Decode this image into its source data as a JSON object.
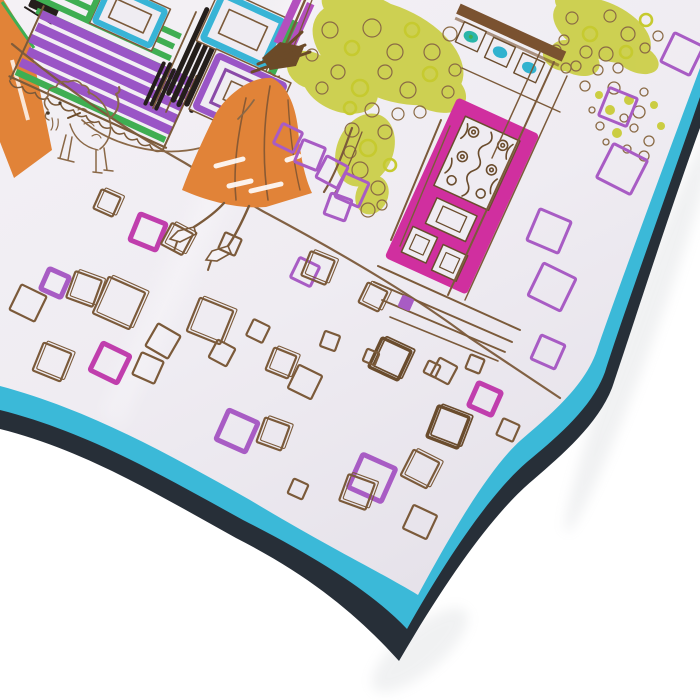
{
  "meta": {
    "description": "Product photo of a square silk scarf laid diagonally on a white background, corner pointing down. The scarf print is a hand-sketched Paris street scene: a woman in an orange coat and brown hat walking a small fluffy dog on a leash, storefronts with a purple striped awning, teal and purple windows, black hatched columns, chartreuse scribbled trees, a pink door with iron scrollwork, and scattered hand-drawn cobblestone squares in brown, purple and magenta. The scarf has a bright turquoise border with a dark navy edge."
  },
  "palette": {
    "background": "#ffffff",
    "fabric": "#efecf2",
    "fabric_dark": "#e6e2ea",
    "turquoise": "#3bb9d8",
    "navy": "#272f38",
    "orange": "#e18338",
    "green": "#3fae52",
    "teal": "#38b4d6",
    "purple": "#9a55c6",
    "purple_square": "#a85cc4",
    "magenta": "#d02f9f",
    "magenta_square": "#c03ead",
    "chartreuse": "#c6ca2f",
    "brown": "#7b5a3a",
    "brown_dark": "#6a4c2d",
    "black_ink": "#241e1b",
    "shadow": "#9aa0a8"
  },
  "scene": {
    "tilt_deg": 24.5,
    "cobblestones": [
      {
        "x": 107,
        "y": 203,
        "s": 21,
        "c": "b",
        "r": 24,
        "d": 1
      },
      {
        "x": 148,
        "y": 232,
        "s": 28,
        "c": "m",
        "r": 22,
        "d": 0
      },
      {
        "x": 177,
        "y": 239,
        "s": 24,
        "c": "b",
        "r": 28,
        "d": 1
      },
      {
        "x": 55,
        "y": 283,
        "s": 22,
        "c": "pt",
        "r": 24,
        "d": 0
      },
      {
        "x": 84,
        "y": 289,
        "s": 28,
        "c": "b",
        "r": 20,
        "d": 1
      },
      {
        "x": 28,
        "y": 303,
        "s": 28,
        "c": "b",
        "r": 26,
        "d": 0
      },
      {
        "x": 119,
        "y": 303,
        "s": 40,
        "c": "b",
        "r": 24,
        "d": 1
      },
      {
        "x": 163,
        "y": 341,
        "s": 26,
        "c": "b",
        "r": 30,
        "d": 0
      },
      {
        "x": 210,
        "y": 321,
        "s": 36,
        "c": "b",
        "r": 22,
        "d": 1
      },
      {
        "x": 258,
        "y": 331,
        "s": 18,
        "c": "b",
        "r": 26,
        "d": 0
      },
      {
        "x": 230,
        "y": 244,
        "s": 18,
        "c": "b",
        "r": 24,
        "d": 0
      },
      {
        "x": 288,
        "y": 138,
        "s": 22,
        "c": "p",
        "r": 26,
        "d": 0
      },
      {
        "x": 310,
        "y": 155,
        "s": 24,
        "c": "p",
        "r": 22,
        "d": 0
      },
      {
        "x": 332,
        "y": 172,
        "s": 24,
        "c": "p",
        "r": 28,
        "d": 0
      },
      {
        "x": 352,
        "y": 190,
        "s": 26,
        "c": "p",
        "r": 24,
        "d": 0
      },
      {
        "x": 338,
        "y": 207,
        "s": 22,
        "c": "p",
        "r": 20,
        "d": 0
      },
      {
        "x": 305,
        "y": 272,
        "s": 22,
        "c": "p",
        "r": 26,
        "d": 0
      },
      {
        "x": 318,
        "y": 268,
        "s": 26,
        "c": "b",
        "r": 22,
        "d": 1
      },
      {
        "x": 373,
        "y": 297,
        "s": 22,
        "c": "b",
        "r": 26,
        "d": 1
      },
      {
        "x": 406,
        "y": 303,
        "s": 13,
        "c": "pf",
        "r": 24,
        "d": 0
      },
      {
        "x": 330,
        "y": 341,
        "s": 16,
        "c": "b",
        "r": 20,
        "d": 0
      },
      {
        "x": 390,
        "y": 359,
        "s": 32,
        "c": "bt",
        "r": 25,
        "d": 1
      },
      {
        "x": 444,
        "y": 371,
        "s": 20,
        "c": "b",
        "r": 28,
        "d": 0
      },
      {
        "x": 475,
        "y": 364,
        "s": 15,
        "c": "b",
        "r": 22,
        "d": 0
      },
      {
        "x": 485,
        "y": 399,
        "s": 25,
        "c": "m",
        "r": 24,
        "d": 0
      },
      {
        "x": 448,
        "y": 427,
        "s": 33,
        "c": "bt",
        "r": 21,
        "d": 1
      },
      {
        "x": 420,
        "y": 469,
        "s": 29,
        "c": "b",
        "r": 27,
        "d": 1
      },
      {
        "x": 372,
        "y": 478,
        "s": 36,
        "c": "pt",
        "r": 24,
        "d": 0
      },
      {
        "x": 357,
        "y": 492,
        "s": 28,
        "c": "b",
        "r": 20,
        "d": 1
      },
      {
        "x": 420,
        "y": 522,
        "s": 26,
        "c": "b",
        "r": 25,
        "d": 0
      },
      {
        "x": 508,
        "y": 430,
        "s": 18,
        "c": "b",
        "r": 24,
        "d": 0
      },
      {
        "x": 682,
        "y": 54,
        "s": 32,
        "c": "p",
        "r": 26,
        "d": 0
      },
      {
        "x": 618,
        "y": 107,
        "s": 30,
        "c": "p",
        "r": 22,
        "d": 0
      },
      {
        "x": 622,
        "y": 169,
        "s": 38,
        "c": "p",
        "r": 27,
        "d": 0
      },
      {
        "x": 549,
        "y": 231,
        "s": 34,
        "c": "p",
        "r": 23,
        "d": 0
      },
      {
        "x": 552,
        "y": 287,
        "s": 36,
        "c": "p",
        "r": 26,
        "d": 0
      },
      {
        "x": 548,
        "y": 352,
        "s": 26,
        "c": "p",
        "r": 24,
        "d": 0
      },
      {
        "x": 52,
        "y": 362,
        "s": 30,
        "c": "b",
        "r": 22,
        "d": 1
      },
      {
        "x": 110,
        "y": 363,
        "s": 30,
        "c": "m",
        "r": 26,
        "d": 0
      },
      {
        "x": 148,
        "y": 368,
        "s": 24,
        "c": "b",
        "r": 24,
        "d": 0
      },
      {
        "x": 222,
        "y": 353,
        "s": 20,
        "c": "b",
        "r": 28,
        "d": 0
      },
      {
        "x": 281,
        "y": 363,
        "s": 24,
        "c": "b",
        "r": 22,
        "d": 1
      },
      {
        "x": 305,
        "y": 382,
        "s": 26,
        "c": "b",
        "r": 26,
        "d": 0
      },
      {
        "x": 237,
        "y": 431,
        "s": 32,
        "c": "pt",
        "r": 24,
        "d": 0
      },
      {
        "x": 273,
        "y": 434,
        "s": 26,
        "c": "b",
        "r": 20,
        "d": 1
      },
      {
        "x": 298,
        "y": 489,
        "s": 16,
        "c": "b",
        "r": 24,
        "d": 0
      },
      {
        "x": 371,
        "y": 357,
        "s": 13,
        "c": "b",
        "r": 22,
        "d": 0
      },
      {
        "x": 432,
        "y": 369,
        "s": 13,
        "c": "b",
        "r": 26,
        "d": 0
      }
    ],
    "bubbles": [
      {
        "x": 585,
        "y": 86,
        "r": 5,
        "f": 0
      },
      {
        "x": 599,
        "y": 95,
        "r": 4,
        "f": 1
      },
      {
        "x": 614,
        "y": 88,
        "r": 6,
        "f": 0
      },
      {
        "x": 629,
        "y": 100,
        "r": 5,
        "f": 1
      },
      {
        "x": 644,
        "y": 92,
        "r": 4,
        "f": 0
      },
      {
        "x": 610,
        "y": 110,
        "r": 5,
        "f": 1
      },
      {
        "x": 624,
        "y": 118,
        "r": 4,
        "f": 0
      },
      {
        "x": 639,
        "y": 112,
        "r": 6,
        "f": 0
      },
      {
        "x": 654,
        "y": 105,
        "r": 4,
        "f": 1
      },
      {
        "x": 600,
        "y": 126,
        "r": 4,
        "f": 0
      },
      {
        "x": 617,
        "y": 133,
        "r": 5,
        "f": 1
      },
      {
        "x": 634,
        "y": 128,
        "r": 4,
        "f": 0
      },
      {
        "x": 649,
        "y": 141,
        "r": 5,
        "f": 0
      },
      {
        "x": 661,
        "y": 126,
        "r": 4,
        "f": 1
      },
      {
        "x": 644,
        "y": 156,
        "r": 5,
        "f": 0
      },
      {
        "x": 627,
        "y": 149,
        "r": 4,
        "f": 0
      },
      {
        "x": 592,
        "y": 110,
        "r": 3,
        "f": 0
      },
      {
        "x": 606,
        "y": 142,
        "r": 3,
        "f": 0
      }
    ],
    "tree_main_loops": [
      {
        "x": 330,
        "y": 30,
        "r": 8,
        "g": 0
      },
      {
        "x": 352,
        "y": 48,
        "r": 7,
        "g": 1
      },
      {
        "x": 372,
        "y": 28,
        "r": 9,
        "g": 0
      },
      {
        "x": 395,
        "y": 52,
        "r": 8,
        "g": 0
      },
      {
        "x": 412,
        "y": 30,
        "r": 7,
        "g": 1
      },
      {
        "x": 432,
        "y": 52,
        "r": 8,
        "g": 0
      },
      {
        "x": 450,
        "y": 34,
        "r": 7,
        "g": 0
      },
      {
        "x": 338,
        "y": 72,
        "r": 7,
        "g": 0
      },
      {
        "x": 360,
        "y": 88,
        "r": 8,
        "g": 1
      },
      {
        "x": 385,
        "y": 72,
        "r": 7,
        "g": 0
      },
      {
        "x": 408,
        "y": 90,
        "r": 8,
        "g": 0
      },
      {
        "x": 430,
        "y": 74,
        "r": 7,
        "g": 1
      },
      {
        "x": 448,
        "y": 92,
        "r": 6,
        "g": 0
      },
      {
        "x": 372,
        "y": 110,
        "r": 7,
        "g": 0
      },
      {
        "x": 398,
        "y": 114,
        "r": 6,
        "g": 0
      },
      {
        "x": 350,
        "y": 108,
        "r": 6,
        "g": 1
      },
      {
        "x": 420,
        "y": 112,
        "r": 6,
        "g": 0
      },
      {
        "x": 455,
        "y": 70,
        "r": 6,
        "g": 0
      },
      {
        "x": 312,
        "y": 55,
        "r": 6,
        "g": 0
      },
      {
        "x": 322,
        "y": 88,
        "r": 6,
        "g": 0
      },
      {
        "x": 352,
        "y": 130,
        "r": 7,
        "g": 0
      },
      {
        "x": 368,
        "y": 148,
        "r": 8,
        "g": 1
      },
      {
        "x": 385,
        "y": 132,
        "r": 7,
        "g": 0
      },
      {
        "x": 360,
        "y": 170,
        "r": 8,
        "g": 0
      },
      {
        "x": 378,
        "y": 188,
        "r": 7,
        "g": 0
      },
      {
        "x": 350,
        "y": 152,
        "r": 6,
        "g": 0
      },
      {
        "x": 390,
        "y": 165,
        "r": 6,
        "g": 1
      },
      {
        "x": 368,
        "y": 210,
        "r": 7,
        "g": 0
      },
      {
        "x": 382,
        "y": 205,
        "r": 5,
        "g": 0
      }
    ],
    "tree_small_loops": [
      {
        "x": 572,
        "y": 18,
        "r": 6,
        "g": 0
      },
      {
        "x": 590,
        "y": 34,
        "r": 7,
        "g": 1
      },
      {
        "x": 610,
        "y": 16,
        "r": 6,
        "g": 0
      },
      {
        "x": 628,
        "y": 34,
        "r": 7,
        "g": 0
      },
      {
        "x": 646,
        "y": 20,
        "r": 6,
        "g": 1
      },
      {
        "x": 586,
        "y": 52,
        "r": 6,
        "g": 0
      },
      {
        "x": 606,
        "y": 54,
        "r": 7,
        "g": 0
      },
      {
        "x": 626,
        "y": 52,
        "r": 6,
        "g": 1
      },
      {
        "x": 645,
        "y": 48,
        "r": 5,
        "g": 0
      },
      {
        "x": 564,
        "y": 40,
        "r": 5,
        "g": 0
      },
      {
        "x": 658,
        "y": 36,
        "r": 5,
        "g": 0
      },
      {
        "x": 576,
        "y": 66,
        "r": 5,
        "g": 0
      },
      {
        "x": 598,
        "y": 70,
        "r": 5,
        "g": 0
      },
      {
        "x": 618,
        "y": 68,
        "r": 5,
        "g": 0
      },
      {
        "x": 556,
        "y": 50,
        "r": 5,
        "g": 0
      },
      {
        "x": 566,
        "y": 68,
        "r": 5,
        "g": 0
      }
    ]
  }
}
